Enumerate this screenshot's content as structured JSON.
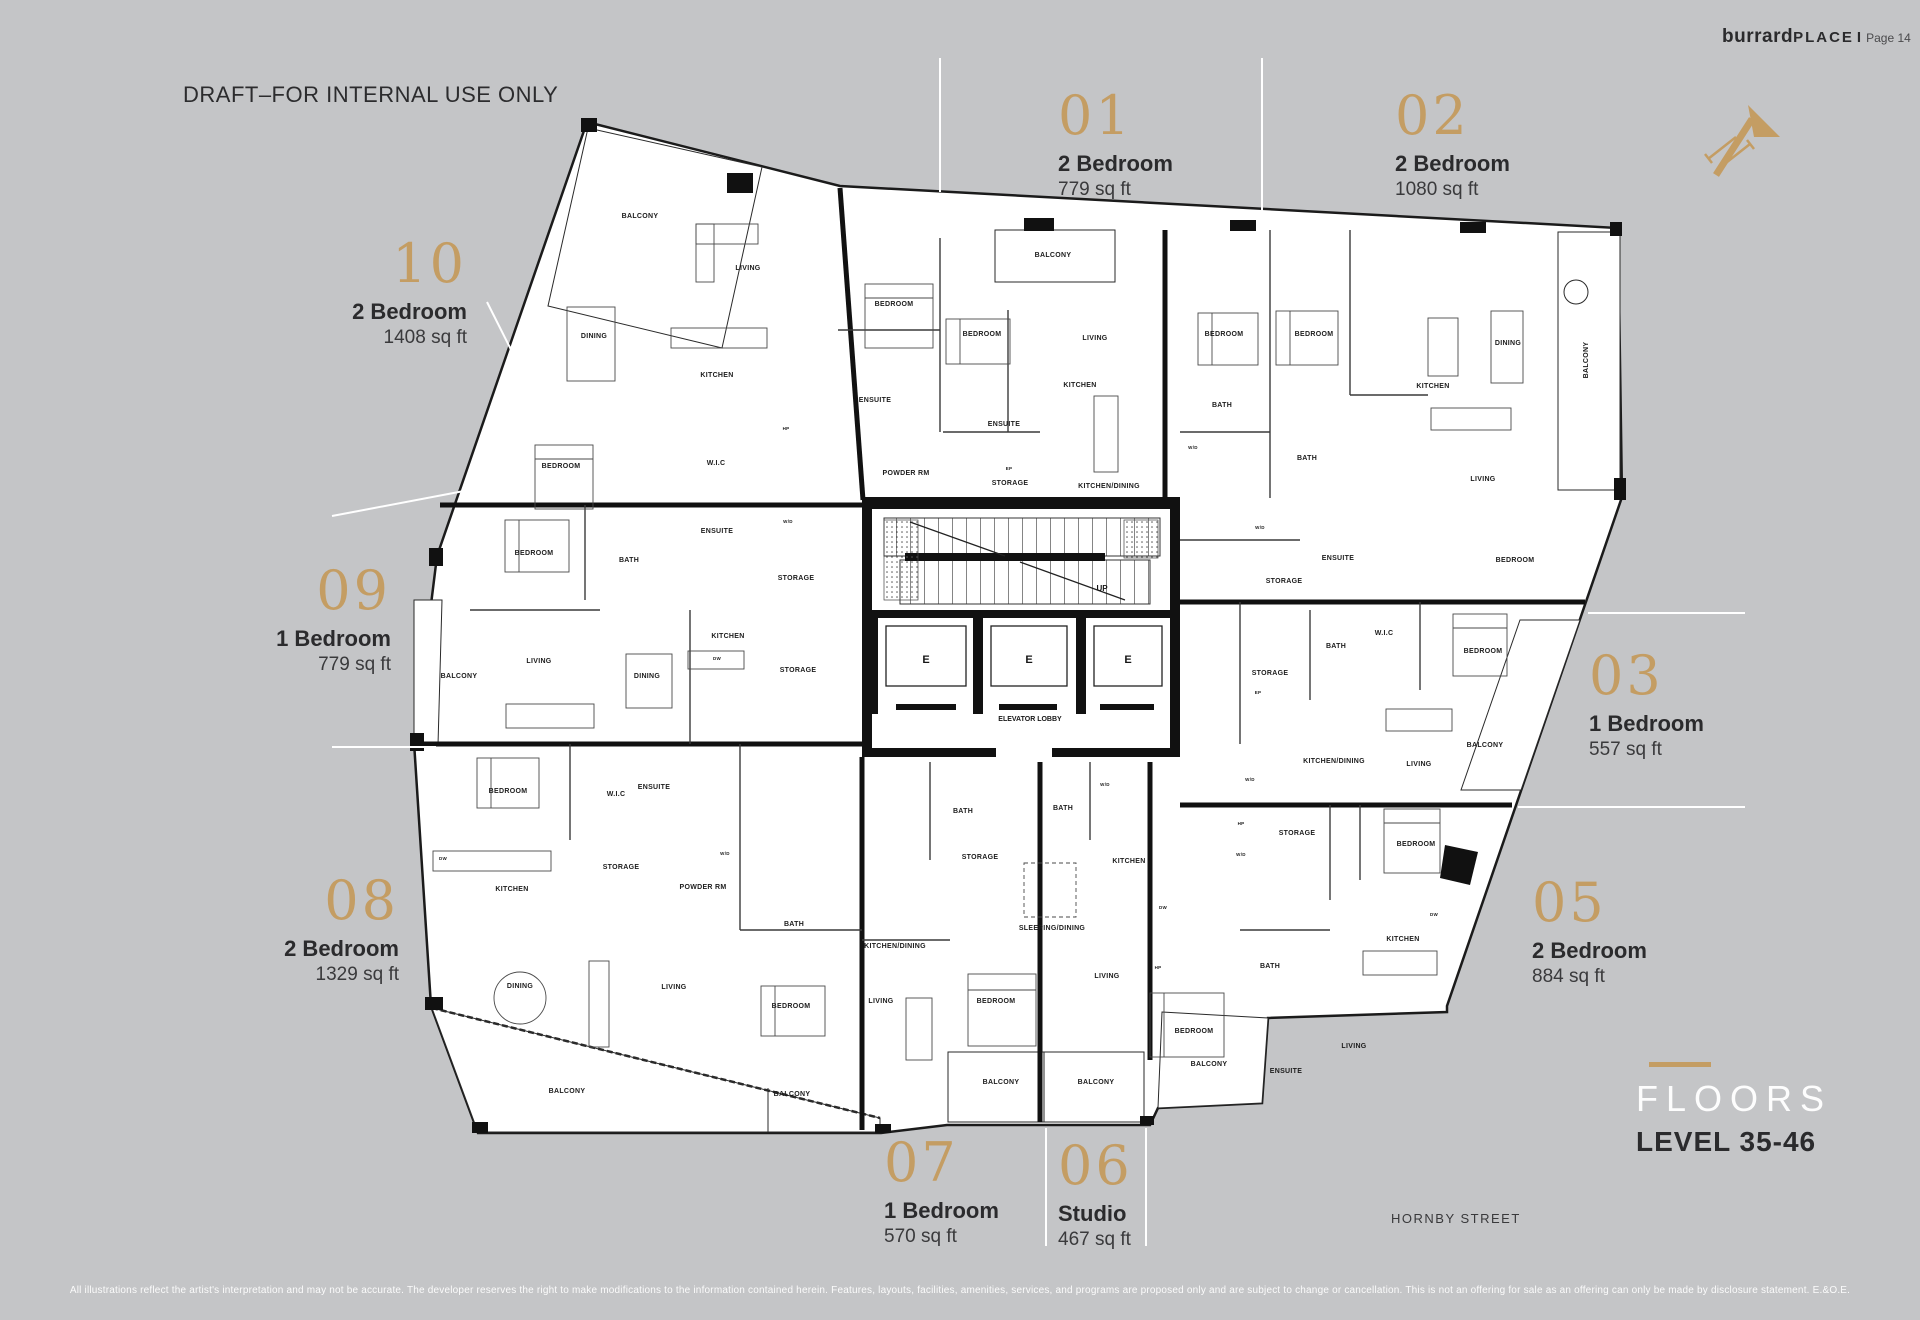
{
  "page": {
    "brand": {
      "name_lower": "burrard",
      "name_upper": "PLACE",
      "separator": "I",
      "page_label": "Page 14"
    },
    "draft_notice": "DRAFT–FOR INTERNAL USE ONLY",
    "floors": {
      "title": "FLOORS",
      "subtitle": "LEVEL 35-46"
    },
    "street_label": "HORNBY STREET",
    "disclaimer": "All illustrations reflect the artist's interpretation and may not be accurate. The developer reserves the right to make modifications to the information contained herein. Features, layouts, facilities, amenities, services, and programs are proposed only and are subject to change or cancellation. This is not an offering for sale as an offering can only be made by disclosure statement. E.&O.E.",
    "colors": {
      "background": "#c4c5c7",
      "gold": "#c49d63",
      "ink": "#2b2b2d",
      "plan_fill": "#ffffff",
      "wall": "#141414",
      "leader_line": "#ffffff"
    }
  },
  "units": {
    "u01": {
      "number": "01",
      "type": "2 Bedroom",
      "area": "779 sq ft"
    },
    "u02": {
      "number": "02",
      "type": "2 Bedroom",
      "area": "1080 sq ft"
    },
    "u03": {
      "number": "03",
      "type": "1 Bedroom",
      "area": "557 sq ft"
    },
    "u05": {
      "number": "05",
      "type": "2 Bedroom",
      "area": "884 sq ft"
    },
    "u06": {
      "number": "06",
      "type": "Studio",
      "area": "467 sq ft"
    },
    "u07": {
      "number": "07",
      "type": "1 Bedroom",
      "area": "570 sq ft"
    },
    "u08": {
      "number": "08",
      "type": "2 Bedroom",
      "area": "1329 sq ft"
    },
    "u09": {
      "number": "09",
      "type": "1 Bedroom",
      "area": "779 sq ft"
    },
    "u10": {
      "number": "10",
      "type": "2 Bedroom",
      "area": "1408 sq ft"
    }
  },
  "plan": {
    "core": {
      "up_label": "UP",
      "elevator_letter": "E",
      "lobby_label": "ELEVATOR LOBBY"
    },
    "rooms": [
      {
        "label": "BALCONY",
        "x": 640,
        "y": 218
      },
      {
        "label": "LIVING",
        "x": 748,
        "y": 270
      },
      {
        "label": "DINING",
        "x": 594,
        "y": 338
      },
      {
        "label": "KITCHEN",
        "x": 717,
        "y": 377
      },
      {
        "label": "W.I.C",
        "x": 716,
        "y": 465
      },
      {
        "label": "BEDROOM",
        "x": 561,
        "y": 468
      },
      {
        "label": "HP",
        "x": 786,
        "y": 430,
        "s": 4.5
      },
      {
        "label": "BEDROOM",
        "x": 894,
        "y": 306
      },
      {
        "label": "ENSUITE",
        "x": 875,
        "y": 402
      },
      {
        "label": "W/D",
        "x": 788,
        "y": 523,
        "s": 4.5
      },
      {
        "label": "BALCONY",
        "x": 1053,
        "y": 257
      },
      {
        "label": "BEDROOM",
        "x": 982,
        "y": 336
      },
      {
        "label": "LIVING",
        "x": 1095,
        "y": 340
      },
      {
        "label": "KITCHEN",
        "x": 1080,
        "y": 387
      },
      {
        "label": "ENSUITE",
        "x": 1004,
        "y": 426
      },
      {
        "label": "POWDER RM",
        "x": 906,
        "y": 475
      },
      {
        "label": "EP",
        "x": 1009,
        "y": 470,
        "s": 4.5
      },
      {
        "label": "STORAGE",
        "x": 1010,
        "y": 485
      },
      {
        "label": "KITCHEN/DINING",
        "x": 1109,
        "y": 488
      },
      {
        "label": "BEDROOM",
        "x": 1224,
        "y": 336
      },
      {
        "label": "BEDROOM",
        "x": 1314,
        "y": 336
      },
      {
        "label": "BATH",
        "x": 1222,
        "y": 407
      },
      {
        "label": "W/D",
        "x": 1193,
        "y": 449,
        "s": 4.5
      },
      {
        "label": "BATH",
        "x": 1307,
        "y": 460
      },
      {
        "label": "KITCHEN",
        "x": 1433,
        "y": 388
      },
      {
        "label": "DINING",
        "x": 1508,
        "y": 345
      },
      {
        "label": "LIVING",
        "x": 1483,
        "y": 481
      },
      {
        "label": "BALCONY",
        "x": 1588,
        "y": 360,
        "r": -90
      },
      {
        "label": "W/D",
        "x": 1260,
        "y": 529,
        "s": 4.5
      },
      {
        "label": "ENSUITE",
        "x": 1338,
        "y": 560
      },
      {
        "label": "BEDROOM",
        "x": 1515,
        "y": 562
      },
      {
        "label": "STORAGE",
        "x": 1284,
        "y": 583
      },
      {
        "label": "STORAGE",
        "x": 1270,
        "y": 675
      },
      {
        "label": "BATH",
        "x": 1336,
        "y": 648
      },
      {
        "label": "W.I.C",
        "x": 1384,
        "y": 635
      },
      {
        "label": "BEDROOM",
        "x": 1483,
        "y": 653
      },
      {
        "label": "EP",
        "x": 1258,
        "y": 694,
        "s": 4.5
      },
      {
        "label": "KITCHEN/DINING",
        "x": 1334,
        "y": 763
      },
      {
        "label": "LIVING",
        "x": 1419,
        "y": 766
      },
      {
        "label": "BALCONY",
        "x": 1485,
        "y": 747
      },
      {
        "label": "W/D",
        "x": 1250,
        "y": 781,
        "s": 4.5
      },
      {
        "label": "HP",
        "x": 1241,
        "y": 825,
        "s": 4.5
      },
      {
        "label": "W/D",
        "x": 1241,
        "y": 856,
        "s": 4.5
      },
      {
        "label": "STORAGE",
        "x": 1297,
        "y": 835
      },
      {
        "label": "BEDROOM",
        "x": 1416,
        "y": 846
      },
      {
        "label": "KITCHEN",
        "x": 1403,
        "y": 941
      },
      {
        "label": "DW",
        "x": 1434,
        "y": 916,
        "s": 4.5
      },
      {
        "label": "BATH",
        "x": 1270,
        "y": 968
      },
      {
        "label": "LIVING",
        "x": 1354,
        "y": 1048
      },
      {
        "label": "ENSUITE",
        "x": 1286,
        "y": 1073
      },
      {
        "label": "BEDROOM",
        "x": 1194,
        "y": 1033
      },
      {
        "label": "BALCONY",
        "x": 1209,
        "y": 1066
      },
      {
        "label": "W/D",
        "x": 1105,
        "y": 786,
        "s": 4.5
      },
      {
        "label": "BATH",
        "x": 1063,
        "y": 810
      },
      {
        "label": "KITCHEN",
        "x": 1129,
        "y": 863
      },
      {
        "label": "DW",
        "x": 1163,
        "y": 909,
        "s": 4.5
      },
      {
        "label": "SLEEPING/DINING",
        "x": 1052,
        "y": 930
      },
      {
        "label": "HP",
        "x": 1158,
        "y": 969,
        "s": 4.5
      },
      {
        "label": "LIVING",
        "x": 1107,
        "y": 978
      },
      {
        "label": "BALCONY",
        "x": 1096,
        "y": 1084
      },
      {
        "label": "BATH",
        "x": 963,
        "y": 813
      },
      {
        "label": "STORAGE",
        "x": 980,
        "y": 859
      },
      {
        "label": "KITCHEN/DINING",
        "x": 895,
        "y": 948
      },
      {
        "label": "LIVING",
        "x": 881,
        "y": 1003
      },
      {
        "label": "BEDROOM",
        "x": 996,
        "y": 1003
      },
      {
        "label": "BALCONY",
        "x": 1001,
        "y": 1084
      },
      {
        "label": "BEDROOM",
        "x": 508,
        "y": 793
      },
      {
        "label": "W.I.C",
        "x": 616,
        "y": 796
      },
      {
        "label": "ENSUITE",
        "x": 654,
        "y": 789
      },
      {
        "label": "KITCHEN",
        "x": 512,
        "y": 891
      },
      {
        "label": "DW",
        "x": 443,
        "y": 860,
        "s": 4.5
      },
      {
        "label": "STORAGE",
        "x": 621,
        "y": 869
      },
      {
        "label": "POWDER RM",
        "x": 703,
        "y": 889
      },
      {
        "label": "W/D",
        "x": 725,
        "y": 855,
        "s": 4.5
      },
      {
        "label": "BATH",
        "x": 794,
        "y": 926
      },
      {
        "label": "DINING",
        "x": 520,
        "y": 988
      },
      {
        "label": "LIVING",
        "x": 674,
        "y": 989
      },
      {
        "label": "BEDROOM",
        "x": 791,
        "y": 1008
      },
      {
        "label": "BALCONY",
        "x": 567,
        "y": 1093
      },
      {
        "label": "BALCONY",
        "x": 792,
        "y": 1096
      },
      {
        "label": "BEDROOM",
        "x": 534,
        "y": 555
      },
      {
        "label": "BATH",
        "x": 629,
        "y": 562
      },
      {
        "label": "ENSUITE",
        "x": 717,
        "y": 533
      },
      {
        "label": "STORAGE",
        "x": 796,
        "y": 580
      },
      {
        "label": "LIVING",
        "x": 539,
        "y": 663
      },
      {
        "label": "DINING",
        "x": 647,
        "y": 678
      },
      {
        "label": "KITCHEN",
        "x": 728,
        "y": 638
      },
      {
        "label": "DW",
        "x": 717,
        "y": 660,
        "s": 4.5
      },
      {
        "label": "STORAGE",
        "x": 798,
        "y": 672
      },
      {
        "label": "BALCONY",
        "x": 459,
        "y": 678
      }
    ]
  }
}
